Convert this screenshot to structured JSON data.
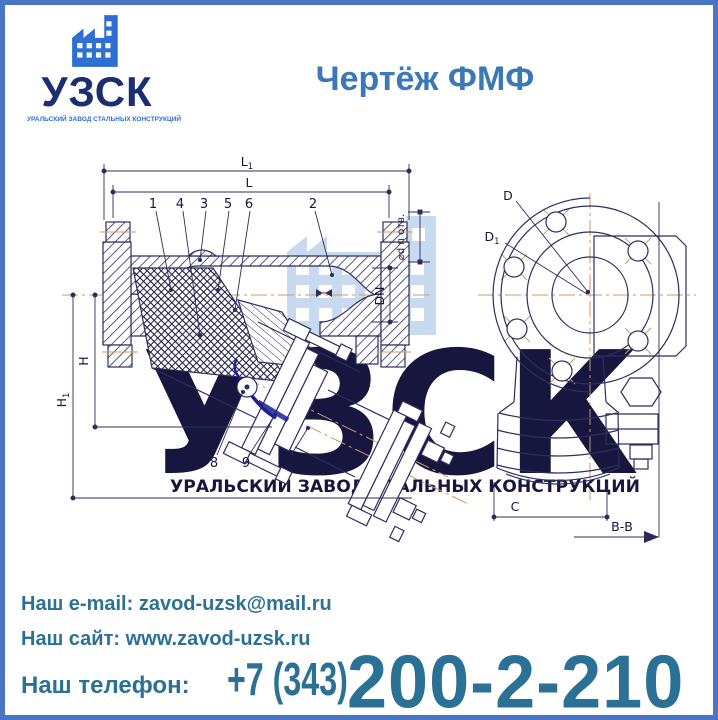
{
  "logo": {
    "name": "УЗСК",
    "tagline": "УРАЛЬСКИЙ ЗАВОД СТАЛЬНЫХ КОНСТРУКЦИЙ"
  },
  "title": "Чертёж ФМФ",
  "watermark": {
    "name": "УЗСК",
    "tagline": "УРАЛЬСКИЙ ЗАВОД СТАЛЬНЫХ КОНСТРУКЦИЙ"
  },
  "drawing": {
    "dims": {
      "L1_main": "L",
      "L1_sub": "1",
      "L": "L",
      "H": "H",
      "H1_main": "H",
      "H1_sub": "1",
      "DN": "DN",
      "D": "D",
      "D1_main": "D",
      "D1_sub": "1",
      "C": "C",
      "section": "В-В",
      "holes_note": "⌀d п отв."
    },
    "callouts": [
      "1",
      "4",
      "3",
      "5",
      "6",
      "2",
      "8",
      "9",
      "7"
    ]
  },
  "contacts": {
    "email_label": "Наш e-mail:",
    "email": "zavod-uzsk@mail.ru",
    "site_label": "Наш сайт:",
    "site": "www.zavod-uzsk.ru",
    "phone_label": "Наш телефон:",
    "phone_code": "+7 (343)",
    "phone_number": "200-2-210"
  },
  "colors": {
    "border_blue": "#4a75c7",
    "title_blue": "#3b79b6",
    "logo_navy": "#1a2f70",
    "logo_blue": "#2e6fd2",
    "contact_blue": "#2b7195",
    "drawing_line_navy": "#2e2e5e",
    "centerline_orange": "#cf9a66",
    "handle_dark_blue": "#1d1d96",
    "watermark_blue": "#c2d7ef"
  }
}
